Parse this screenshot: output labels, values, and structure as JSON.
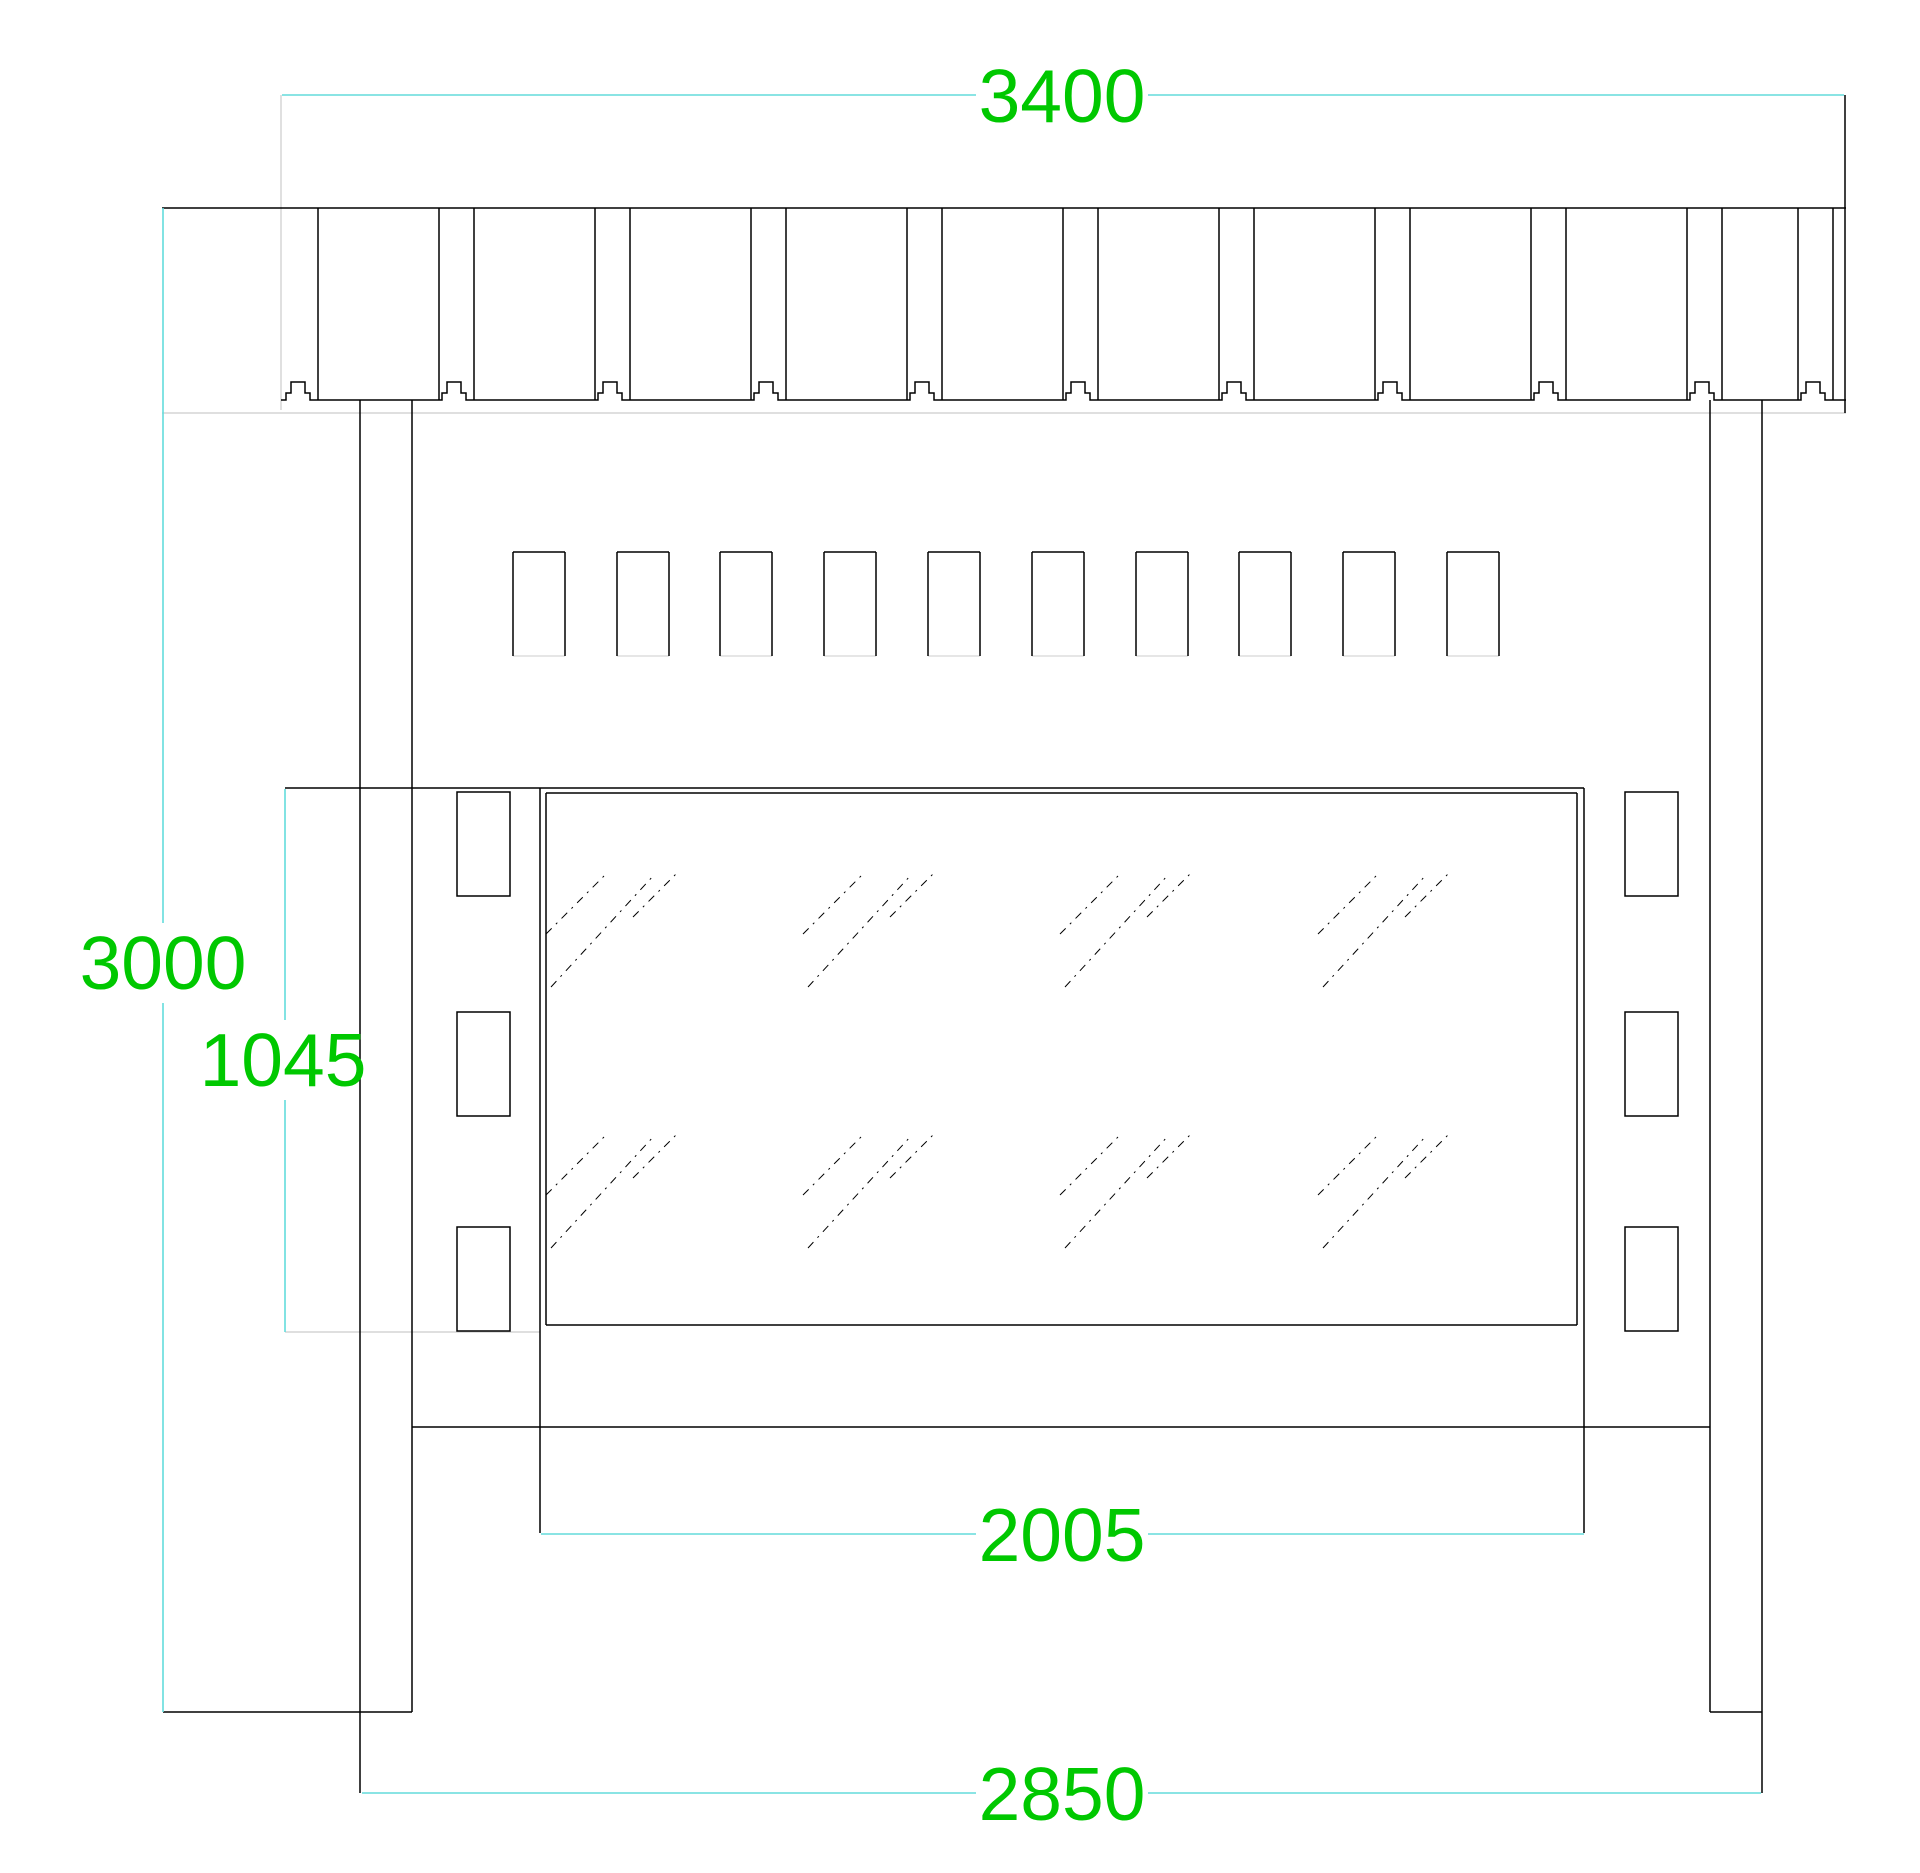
{
  "drawing": {
    "canvas": {
      "width": 1920,
      "height": 1873,
      "background": "#ffffff"
    },
    "colors": {
      "outline": "#000000",
      "dim_line": "#63dcdc",
      "dim_text": "#00c800",
      "faint": "#cccccc"
    },
    "text_style": {
      "font_size": 75
    },
    "roof_band": {
      "left": 162,
      "right": 1846,
      "top": 208,
      "bottom": 400,
      "gap_lefts": [
        283,
        439,
        595,
        751,
        907,
        1063,
        1219,
        1375,
        1531,
        1687,
        1798
      ],
      "gap_width": 35,
      "bottom_start_x": 281,
      "right_edge_x": 1845,
      "right_edge_top": 95,
      "right_edge_bottom": 413,
      "faint_line_y": 413
    },
    "posts": {
      "left": {
        "x1": 360,
        "x2": 412
      },
      "right": {
        "x1": 1710,
        "x2": 1762
      },
      "top": 400,
      "ground_y": 1712,
      "ext_bottom": 1793
    },
    "ground": {
      "y": 1712,
      "left_x1": 163,
      "left_x2": 412,
      "right_x1": 1710,
      "right_x2": 1762
    },
    "slats": {
      "lefts": [
        513,
        617,
        720,
        824,
        928,
        1032,
        1136,
        1239,
        1343,
        1447
      ],
      "width": 52,
      "top": 552,
      "bottom": 656
    },
    "glass": {
      "frame_left_x": 540,
      "frame_right_x": 1584,
      "frame_top_y": 788,
      "frame_ext_bottom_y": 1533,
      "top_ext_left_x": 285,
      "pane": {
        "left": 546,
        "top": 793,
        "right": 1577,
        "bottom": 1325
      },
      "bottom_faint": {
        "y": 1332,
        "x1": 285,
        "x2": 540
      },
      "rail": {
        "y": 1427,
        "x1": 412,
        "x2": 1710
      },
      "hatch": {
        "col_anchors": [
          546,
          803,
          1060,
          1318
        ],
        "row_anchors": [
          987,
          1248
        ],
        "strokes": [
          [
            0,
            -53,
            62,
            -115
          ],
          [
            5,
            0,
            108,
            -112
          ],
          [
            87,
            -70,
            131,
            -114
          ]
        ],
        "dash": "8 6 2 6"
      }
    },
    "tabs": {
      "left_x": 457,
      "right_x": 1625,
      "width": 53,
      "height": 104,
      "tops": [
        792,
        1012,
        1227
      ]
    },
    "dimensions": [
      {
        "label": "3400",
        "type": "h",
        "x1": 282,
        "x2": 1844,
        "y": 95,
        "tx": 1062,
        "ty": 96,
        "half_gap": 86
      },
      {
        "label": "3000",
        "type": "v",
        "x": 163,
        "y1": 208,
        "y2": 1712,
        "tx": 163,
        "ty": 963,
        "half_gap": 40
      },
      {
        "label": "1045",
        "type": "v",
        "x": 285,
        "y1": 789,
        "y2": 1332,
        "tx": 283,
        "ty": 1060,
        "half_gap": 40
      },
      {
        "label": "2005",
        "type": "h",
        "x1": 541,
        "x2": 1584,
        "y": 1534,
        "tx": 1062,
        "ty": 1535,
        "half_gap": 86
      },
      {
        "label": "2850",
        "type": "h",
        "x1": 362,
        "x2": 1761,
        "y": 1793,
        "tx": 1062,
        "ty": 1794,
        "half_gap": 86
      }
    ],
    "extension_lines": [
      {
        "x1": 281,
        "y1": 95,
        "x2": 281,
        "y2": 410,
        "faint": true
      }
    ]
  }
}
